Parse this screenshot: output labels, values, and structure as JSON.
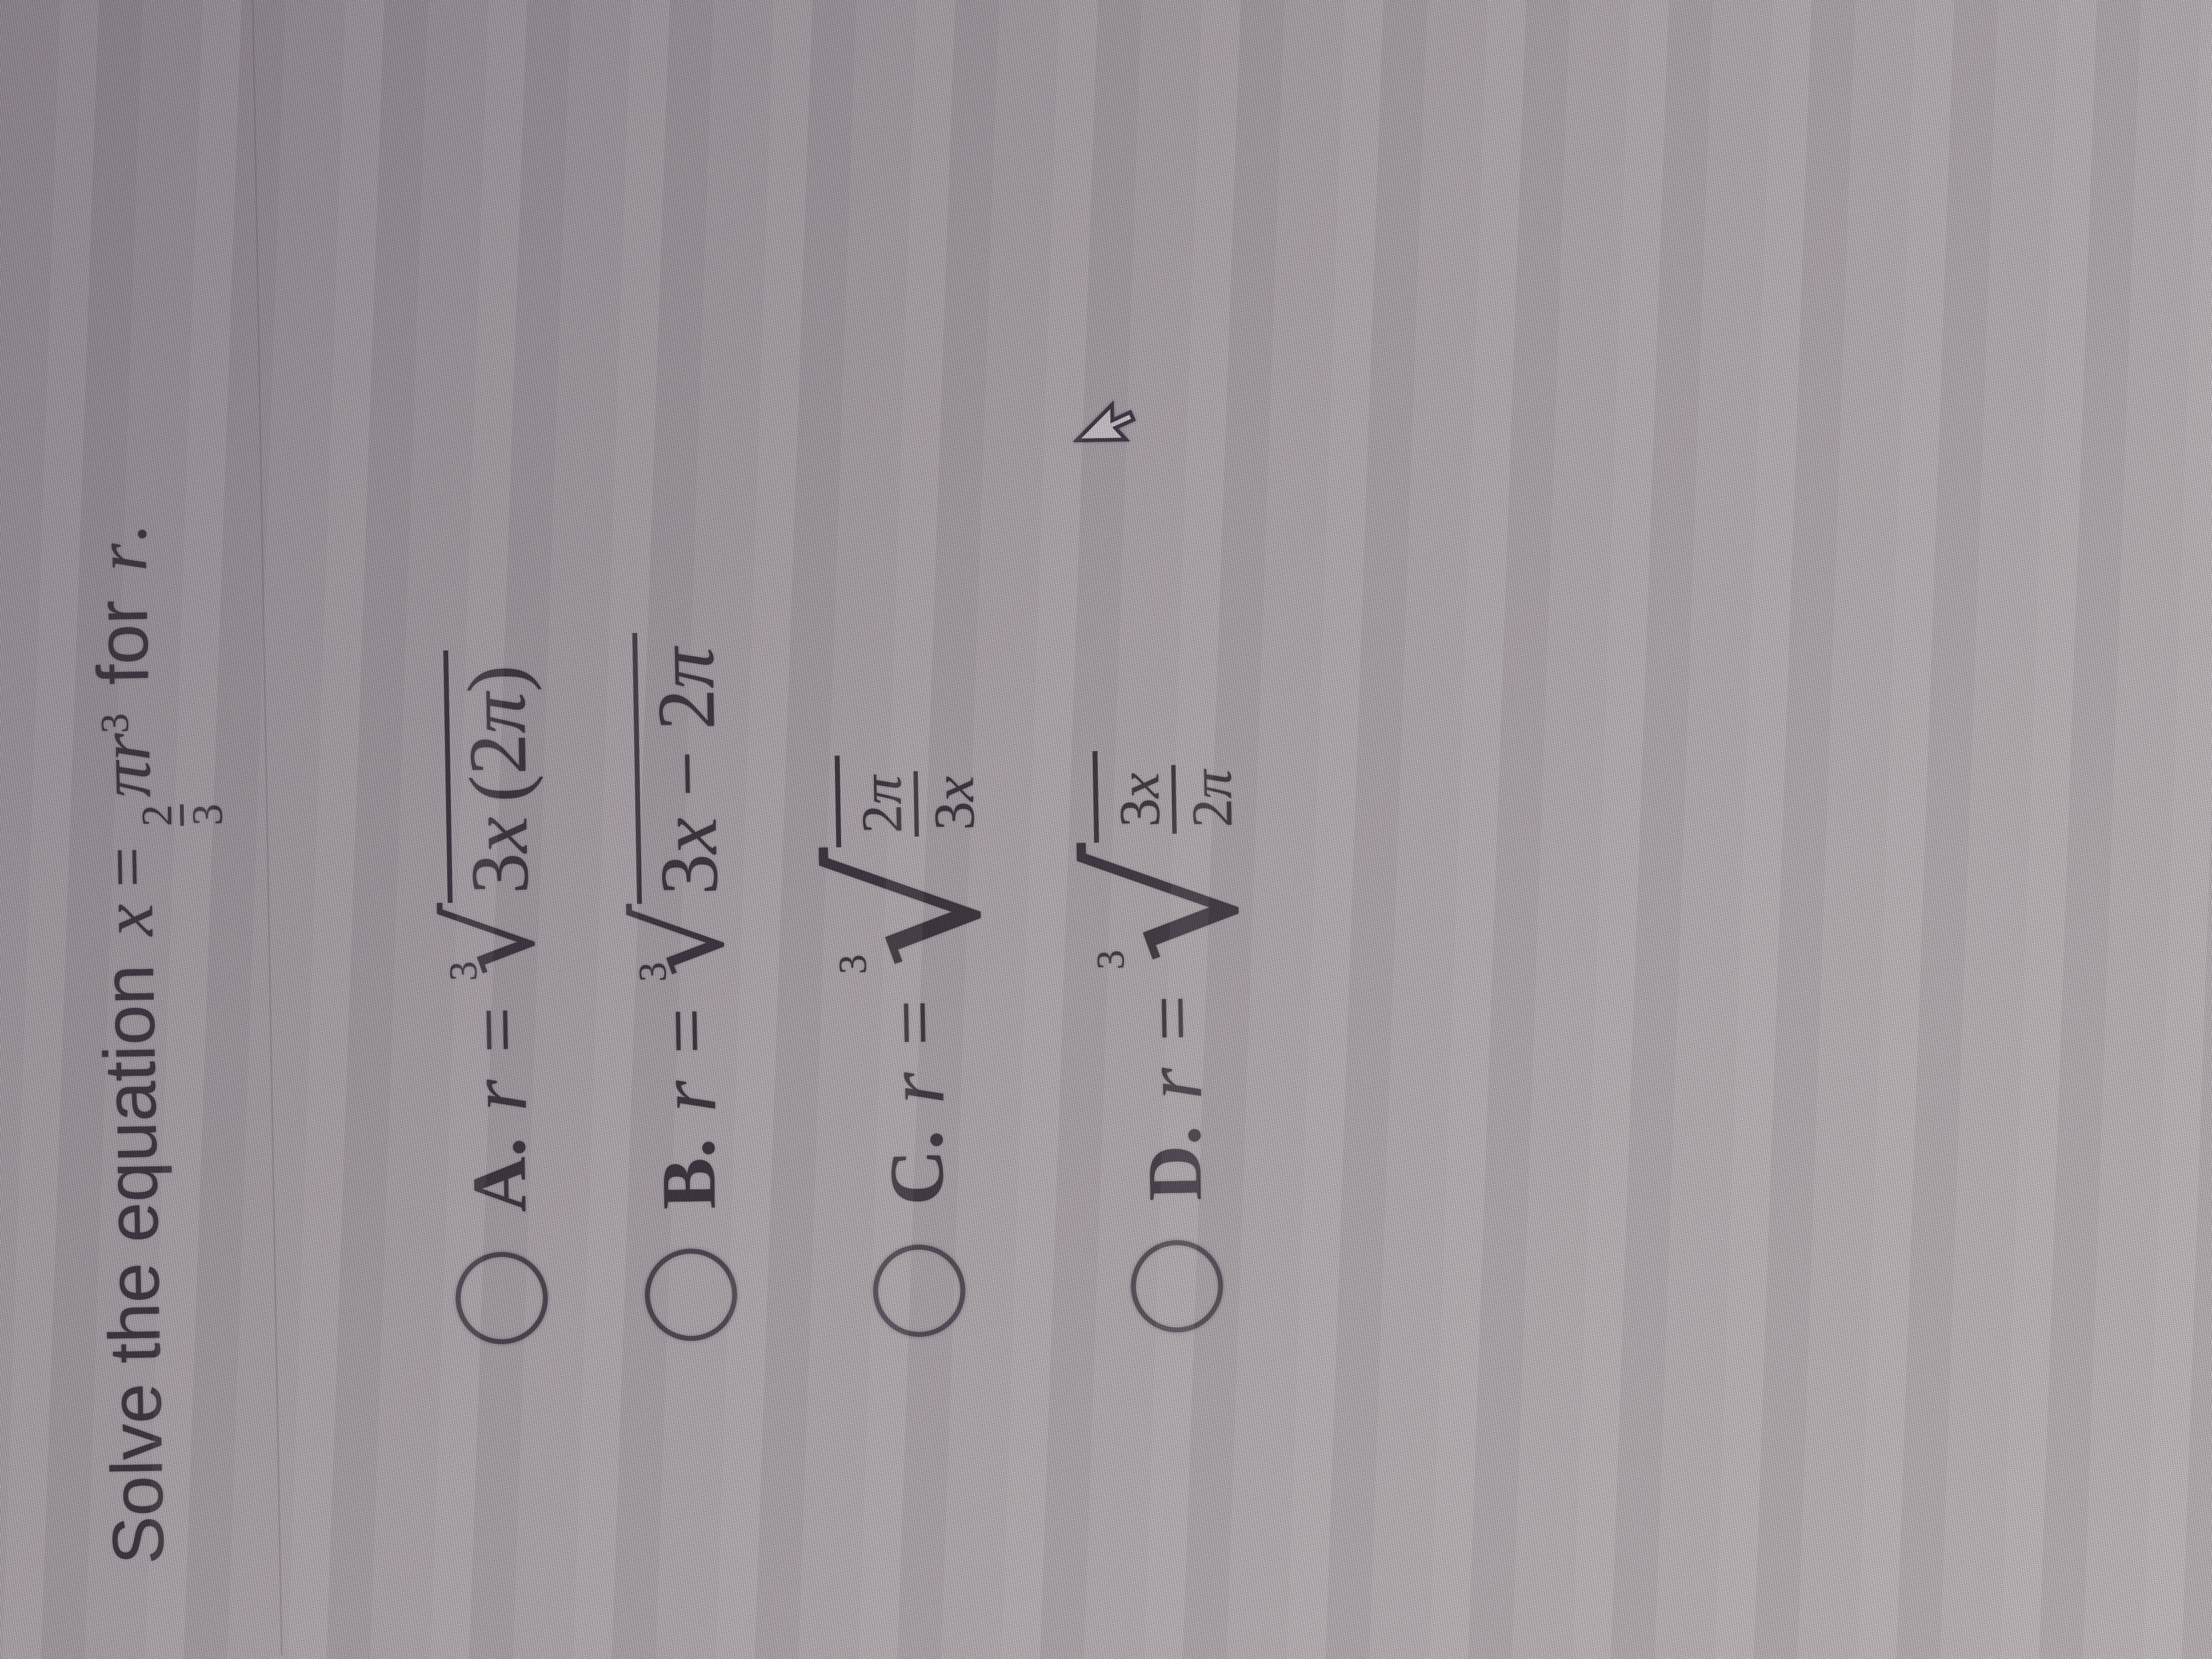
{
  "question": {
    "prefix": "Solve the equation",
    "math": {
      "lhs": "x",
      "equals": "=",
      "fraction": {
        "numerator": "2",
        "denominator": "3"
      },
      "pi": "π",
      "variable": "r",
      "exponent": "3"
    },
    "suffix_word": "for",
    "suffix_variable": "r",
    "period": "."
  },
  "options": [
    {
      "id": "A",
      "label": "A.",
      "selected": false,
      "lhs": "r",
      "equals": "=",
      "root_index": "3",
      "surd": "√",
      "radicand": {
        "kind": "inline",
        "tokens": [
          {
            "t": "3",
            "italic": false
          },
          {
            "t": "x",
            "italic": true
          },
          {
            "t": "(",
            "italic": false
          },
          {
            "t": "2",
            "italic": false
          },
          {
            "t": "π",
            "italic": true
          },
          {
            "t": ")",
            "italic": false
          }
        ],
        "display": "3x(2π)"
      },
      "formula_text": "r = ∛(3x(2π))"
    },
    {
      "id": "B",
      "label": "B.",
      "selected": false,
      "lhs": "r",
      "equals": "=",
      "root_index": "3",
      "surd": "√",
      "radicand": {
        "kind": "inline",
        "tokens": [
          {
            "t": "3",
            "italic": false
          },
          {
            "t": "x",
            "italic": true
          },
          {
            "t": " − ",
            "italic": false
          },
          {
            "t": "2",
            "italic": false
          },
          {
            "t": "π",
            "italic": true
          }
        ],
        "display": "3x − 2π"
      },
      "formula_text": "r = ∛(3x − 2π)"
    },
    {
      "id": "C",
      "label": "C.",
      "selected": false,
      "lhs": "r",
      "equals": "=",
      "root_index": "3",
      "surd": "√",
      "radicand": {
        "kind": "fraction",
        "num_tokens": [
          {
            "t": "2",
            "italic": false
          },
          {
            "t": "π",
            "italic": true
          }
        ],
        "den_tokens": [
          {
            "t": "3",
            "italic": false
          },
          {
            "t": "x",
            "italic": true
          }
        ],
        "display": "2π / 3x"
      },
      "formula_text": "r = ∛(2π/3x)"
    },
    {
      "id": "D",
      "label": "D.",
      "selected": false,
      "lhs": "r",
      "equals": "=",
      "root_index": "3",
      "surd": "√",
      "radicand": {
        "kind": "fraction",
        "num_tokens": [
          {
            "t": "3",
            "italic": false
          },
          {
            "t": "x",
            "italic": true
          }
        ],
        "den_tokens": [
          {
            "t": "2",
            "italic": false
          },
          {
            "t": "π",
            "italic": true
          }
        ],
        "display": "3x / 2π"
      },
      "formula_text": "r = ∛(3x/2π)"
    }
  ],
  "cursor": {
    "icon": "arrow-pointer"
  },
  "colors": {
    "page_background": "#b2abaf",
    "text": "#27222b",
    "radio_outline": "#3b3540",
    "divider": "rgba(62,52,64,0.22)"
  }
}
